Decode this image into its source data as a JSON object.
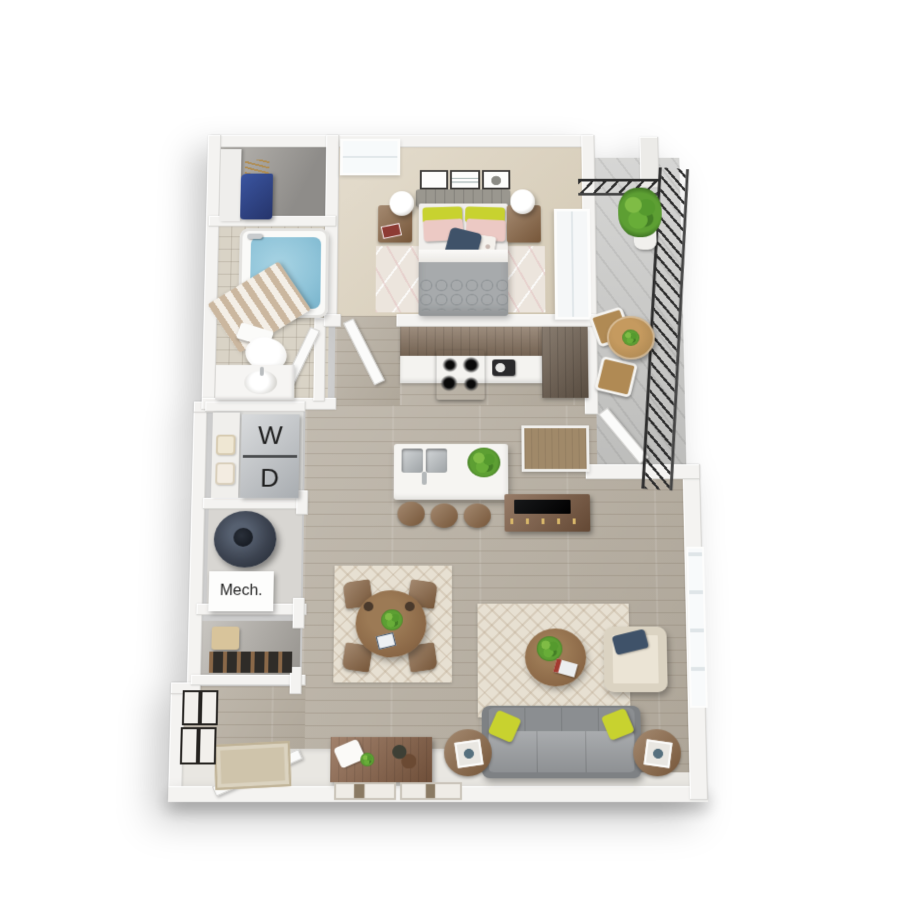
{
  "scene": {
    "kind": "3d-floorplan-render",
    "description": "Top-down 3D rendering of a one-bedroom, one-bath apartment with balcony",
    "background": "#ffffff"
  },
  "labels": {
    "washer": "W",
    "dryer": "D",
    "mechanical": "Mech."
  },
  "palette": {
    "walls": "#f4f3f1",
    "wood_floor": "#b9b1a4",
    "bedroom_carpet": "#dbd1bd",
    "bath_tile": "#d9d3c6",
    "balcony_concrete": "#c8c8c6",
    "tub_water": "#8ec3d8",
    "furniture_wood": "#8a6848",
    "cabinet_wood": "#84705d",
    "sofa_gray": "#8b8e91",
    "accent_yellow": "#c8d22f",
    "accent_pink": "#eccac6",
    "accent_navy": "#3f5269",
    "plant_green": "#5d9f33",
    "railing_black": "#2c2c2c",
    "water_heater": "#3c4350"
  },
  "objects": [
    "walk-in-closet",
    "bathtub",
    "shower-curtain",
    "toilet",
    "vanity-sink",
    "queen-bed",
    "nightstands",
    "table-lamps",
    "wall-art-frames",
    "bedroom-rug",
    "kitchen-cabinets",
    "range-stove",
    "coffee-maker",
    "refrigerator",
    "kitchen-island",
    "double-sink",
    "bar-stools",
    "stacked-washer-dryer",
    "water-heater",
    "mechanical-closet",
    "entry-closet",
    "dining-table",
    "dining-chairs",
    "dining-rug",
    "media-console",
    "tv",
    "desk-nook",
    "living-rug",
    "coffee-table",
    "armchair",
    "sofa",
    "side-tables",
    "console-table",
    "leaning-art",
    "entry-door",
    "doormat",
    "entry-frames",
    "balcony",
    "balcony-railing",
    "potted-plants",
    "bistro-table",
    "bistro-chairs"
  ]
}
